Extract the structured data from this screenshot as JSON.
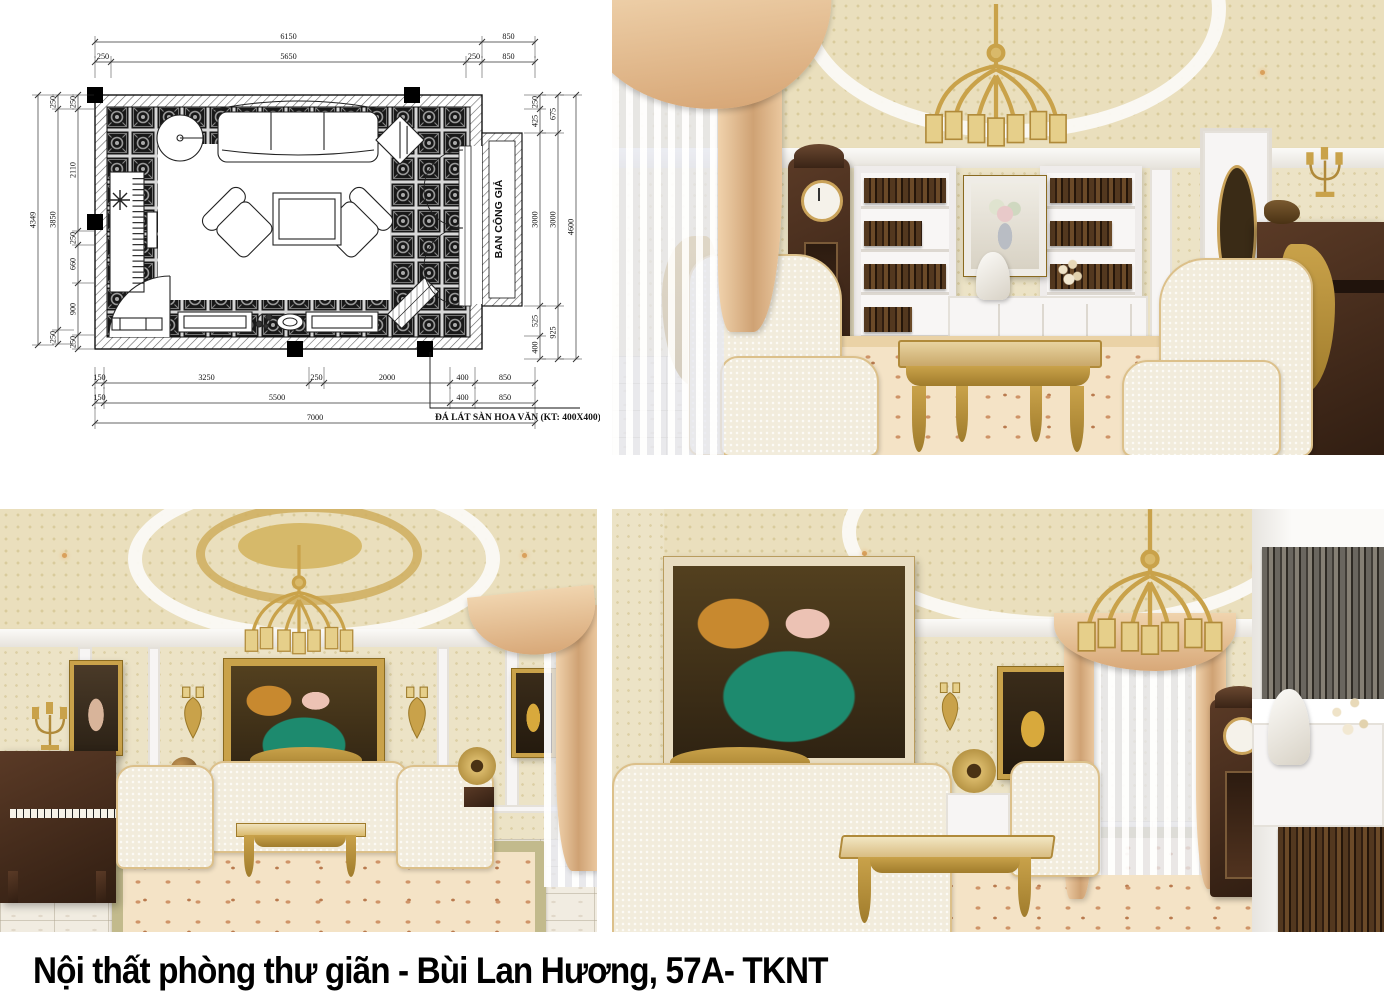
{
  "caption": {
    "text": "Nội thất phòng thư giãn - Bùi Lan Hương, 57A- TKNT"
  },
  "floor_plan": {
    "balcony_label": "BAN CÔNG GIẢ",
    "floor_note": "ĐÁ LÁT SÀN HOA VĂN (KT: 400X400)",
    "dims": {
      "top1": [
        "6150",
        "850"
      ],
      "top2": [
        "250",
        "5650",
        "250",
        "850"
      ],
      "bottom1": [
        "150",
        "3250",
        "250",
        "2000",
        "400",
        "850"
      ],
      "bottom2": [
        "150",
        "5500",
        "400",
        "850"
      ],
      "bottom3": [
        "7000"
      ],
      "left_outer": [
        "4349"
      ],
      "left_mid": [
        "250",
        "3850",
        "250"
      ],
      "left_inner": [
        "250",
        "2110",
        "250",
        "660",
        "900",
        "250"
      ],
      "right_inner": [
        "250",
        "425",
        "3000",
        "525",
        "400"
      ],
      "right_mid": [
        "675",
        "3000",
        "925"
      ],
      "right_outer": [
        "4600"
      ]
    }
  },
  "palette": {
    "gold": "#c9a24a",
    "wood_dark": "#4a2f1e",
    "wall_beige": "#ece3c6",
    "ceiling_beige": "#eadfbd",
    "cream_upholstery": "#f2ecdc",
    "peach_curtain": "#eac79c",
    "rug_accent": "#c4785a",
    "plan_line": "#111111"
  }
}
